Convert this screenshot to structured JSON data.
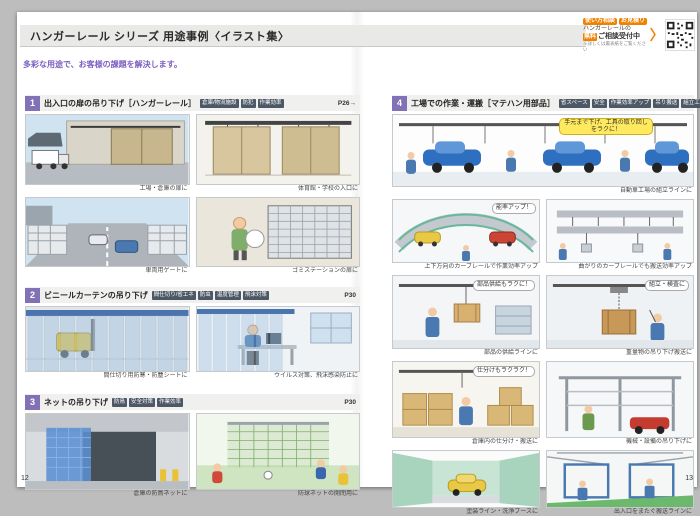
{
  "header": {
    "title": "ハンガーレール シリーズ 用途事例〈イラスト集〉",
    "subtitle": "多彩な用途で、お客様の課題を解決します。",
    "promo": {
      "badges": [
        "使い方相談",
        "お見積り"
      ],
      "line1": "ハンガーレールの",
      "highlight": "無料",
      "line2": "ご相談受付中",
      "note": "※詳しくは裏表紙をご覧ください",
      "arrow": "〉"
    }
  },
  "pages": {
    "left_number": "12",
    "right_number": "13"
  },
  "sections": [
    {
      "number": "1",
      "title": "出入口の扉の吊り下げ［ハンガーレール］",
      "tags": [
        "倉庫/物流施設",
        "防犯",
        "作業効率"
      ],
      "page_ref": "P26→",
      "items": [
        {
          "caption": "工場・倉庫の扉に"
        },
        {
          "caption": "体育館・学校の入口に"
        },
        {
          "caption": "車両用ゲートに"
        },
        {
          "caption": "ゴミステーションの扉に"
        }
      ]
    },
    {
      "number": "2",
      "title": "ビニールカーテンの吊り下げ",
      "tags": [
        "間仕切り/省エネ",
        "防虫",
        "温度管理",
        "飛沫対策"
      ],
      "page_ref": "P30",
      "items": [
        {
          "caption": "間仕切り用防寒・防塵シートに"
        },
        {
          "caption": "ウイルス対策、飛沫感染防止に"
        }
      ]
    },
    {
      "number": "3",
      "title": "ネットの吊り下げ",
      "tags": [
        "防鳥",
        "安全対策",
        "作業効率"
      ],
      "page_ref": "P30",
      "items": [
        {
          "caption": "倉庫の防鳥ネットに"
        },
        {
          "caption": "防球ネットの開閉用に"
        }
      ]
    },
    {
      "number": "4",
      "title": "工場での作業・運搬［マテハン用部品］",
      "tags": [
        "省スペース",
        "安全",
        "作業効率アップ",
        "吊り搬送",
        "組立工場"
      ],
      "page_ref": "P64",
      "items": [
        {
          "caption": "自動車工場の組立ラインに",
          "bubble": "手元まで下げ、工具の取り回しをラクに！"
        },
        {
          "caption": "上下方向のカーブレールで作業効率アップ",
          "bubble": "能率アップ！"
        },
        {
          "caption": "曲がりのカーブレールでも搬送効率アップ"
        },
        {
          "caption": "部品の供給ラインに",
          "bubble": "部品供給もラクに！"
        },
        {
          "caption": "重量物の吊り下げ搬送に",
          "bubble": "組立・検査に"
        },
        {
          "caption": "倉庫内の仕分け・搬送に",
          "bubble": "仕分けもラクラク！"
        },
        {
          "caption": "機械・設備の吊り下げに"
        },
        {
          "caption": "塗装ライン・洗浄ブースに"
        },
        {
          "caption": "出入口をまたぐ搬送ラインに"
        }
      ]
    }
  ]
}
